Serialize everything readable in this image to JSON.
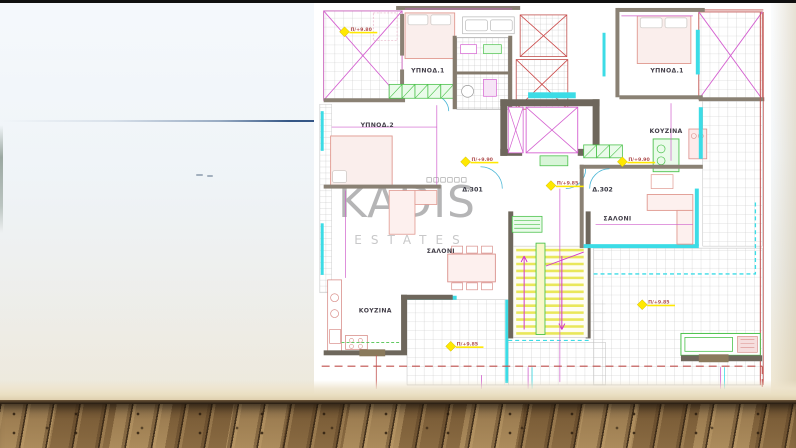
{
  "watermark": {
    "title": "KADIS",
    "subtitle": "ESTATES"
  },
  "plan": {
    "labels": [
      {
        "label": "ΥΠΝΟΔ.1"
      },
      {
        "label": "ΥΠΝΟΔ.2"
      },
      {
        "label": "Δ.301"
      },
      {
        "label": "ΣΑΛΟΝΙ"
      },
      {
        "label": "ΚΟΥΖΙΝΑ"
      },
      {
        "label": "ΥΠΝΟΔ.1"
      },
      {
        "label": "ΚΟΥΖΙΝΑ"
      },
      {
        "label": "Δ.302"
      },
      {
        "label": "ΣΑΛΟΝΙ"
      }
    ],
    "markers": [
      {
        "label": "Π/+9.80"
      },
      {
        "label": "Π/+9.90"
      },
      {
        "label": "Π/+9.85"
      },
      {
        "label": "Π/+9.90"
      },
      {
        "label": "Π/+9.85"
      },
      {
        "label": "Π/+9.85"
      }
    ],
    "colors": {
      "dimension": "#cf5ecb",
      "window": "#3cdce6",
      "wall": "#857b6d",
      "stair_tread": "#e9e75a",
      "marker": "#ffe800",
      "closet": "#4cc24c",
      "furniture": "#e0988f",
      "railing": "#c0504d"
    }
  }
}
